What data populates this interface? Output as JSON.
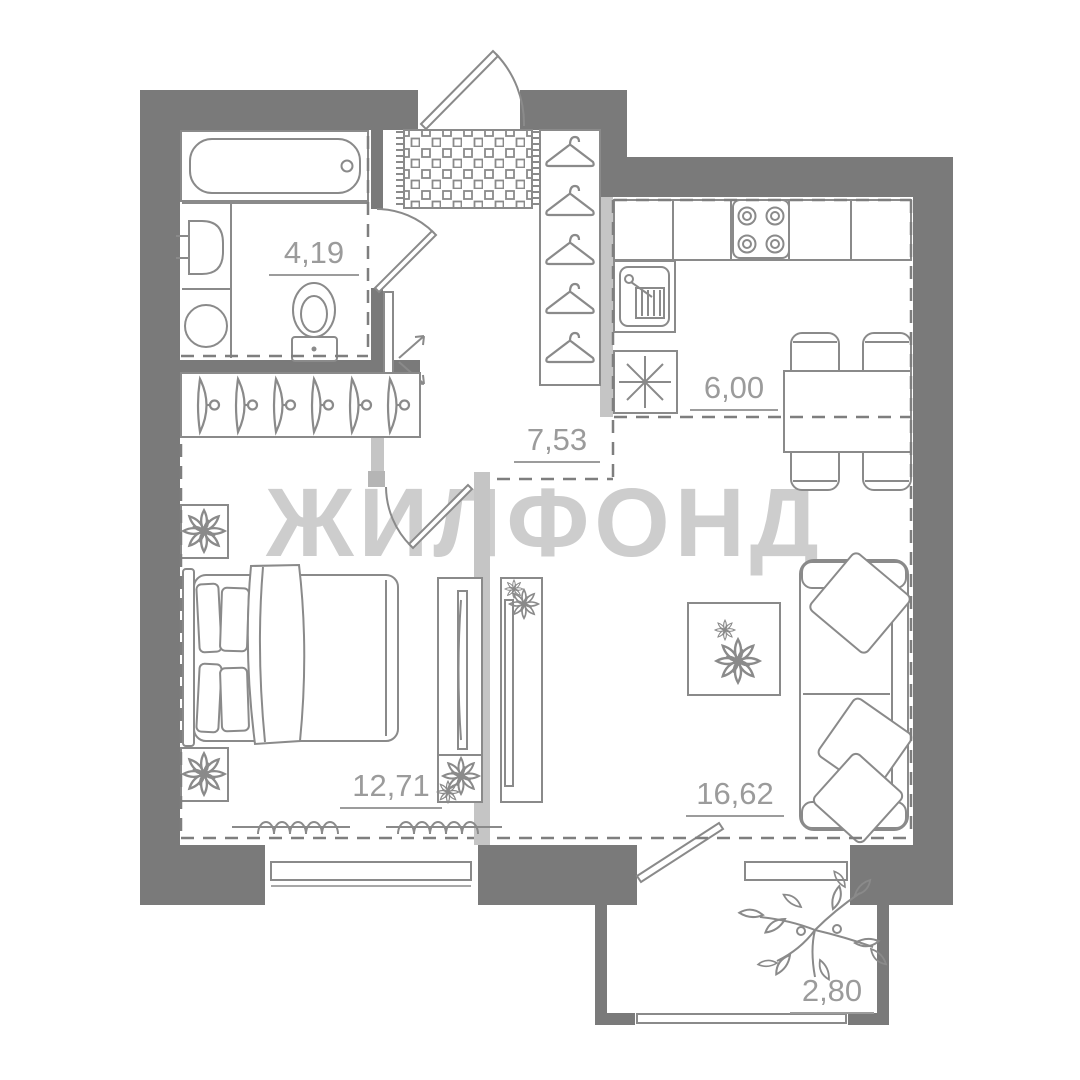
{
  "watermark": {
    "text": "ЖИЛФОНД"
  },
  "rooms": {
    "bathroom": {
      "name": "bathroom",
      "area": "4,19"
    },
    "hallway": {
      "name": "hallway",
      "area": "7,53"
    },
    "kitchen": {
      "name": "kitchen",
      "area": "6,00"
    },
    "bedroom": {
      "name": "bedroom",
      "area": "12,71"
    },
    "living_room": {
      "name": "living-room",
      "area": "16,62"
    },
    "balcony": {
      "name": "balcony",
      "area": "2,80"
    }
  },
  "colors": {
    "wall": "#7a7a7a",
    "wall_light": "#c5c5c5",
    "furniture_line": "#8a8a8a",
    "dashed_line": "#7e7e7e",
    "label_text": "#9b9b9b",
    "watermark": "#cdcdcd",
    "background": "#ffffff"
  }
}
